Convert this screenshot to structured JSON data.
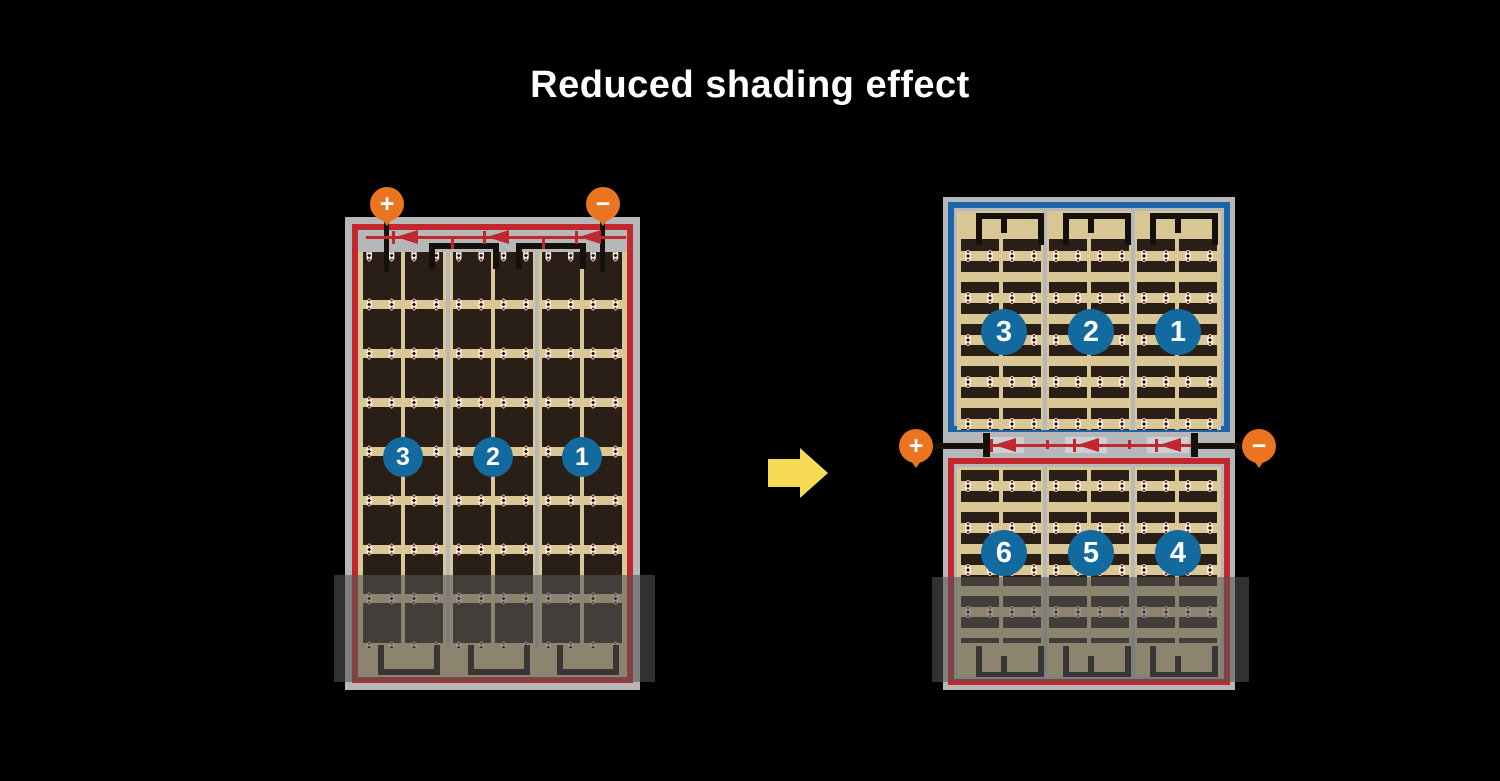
{
  "title": "Reduced shading effect",
  "left_module": {
    "labels": [
      "3",
      "2",
      "1"
    ],
    "positive": "+",
    "negative": "−"
  },
  "right_module": {
    "top_labels": [
      "3",
      "2",
      "1"
    ],
    "bottom_labels": [
      "6",
      "5",
      "4"
    ],
    "positive": "+",
    "negative": "−"
  },
  "colors": {
    "background": "#000000",
    "frame_gray": "#b6b7b9",
    "cell_bg_tan": "#d9c795",
    "cell_dark": "#2a1f17",
    "string_border_red": "#c1272d",
    "string_border_blue": "#1d64a6",
    "badge_blue": "#136a9f",
    "terminal_orange": "#ea7420",
    "arrow_yellow": "#f8db55",
    "diode_red": "#c1272d",
    "shading_overlay": "rgba(85,85,85,0.58)"
  }
}
